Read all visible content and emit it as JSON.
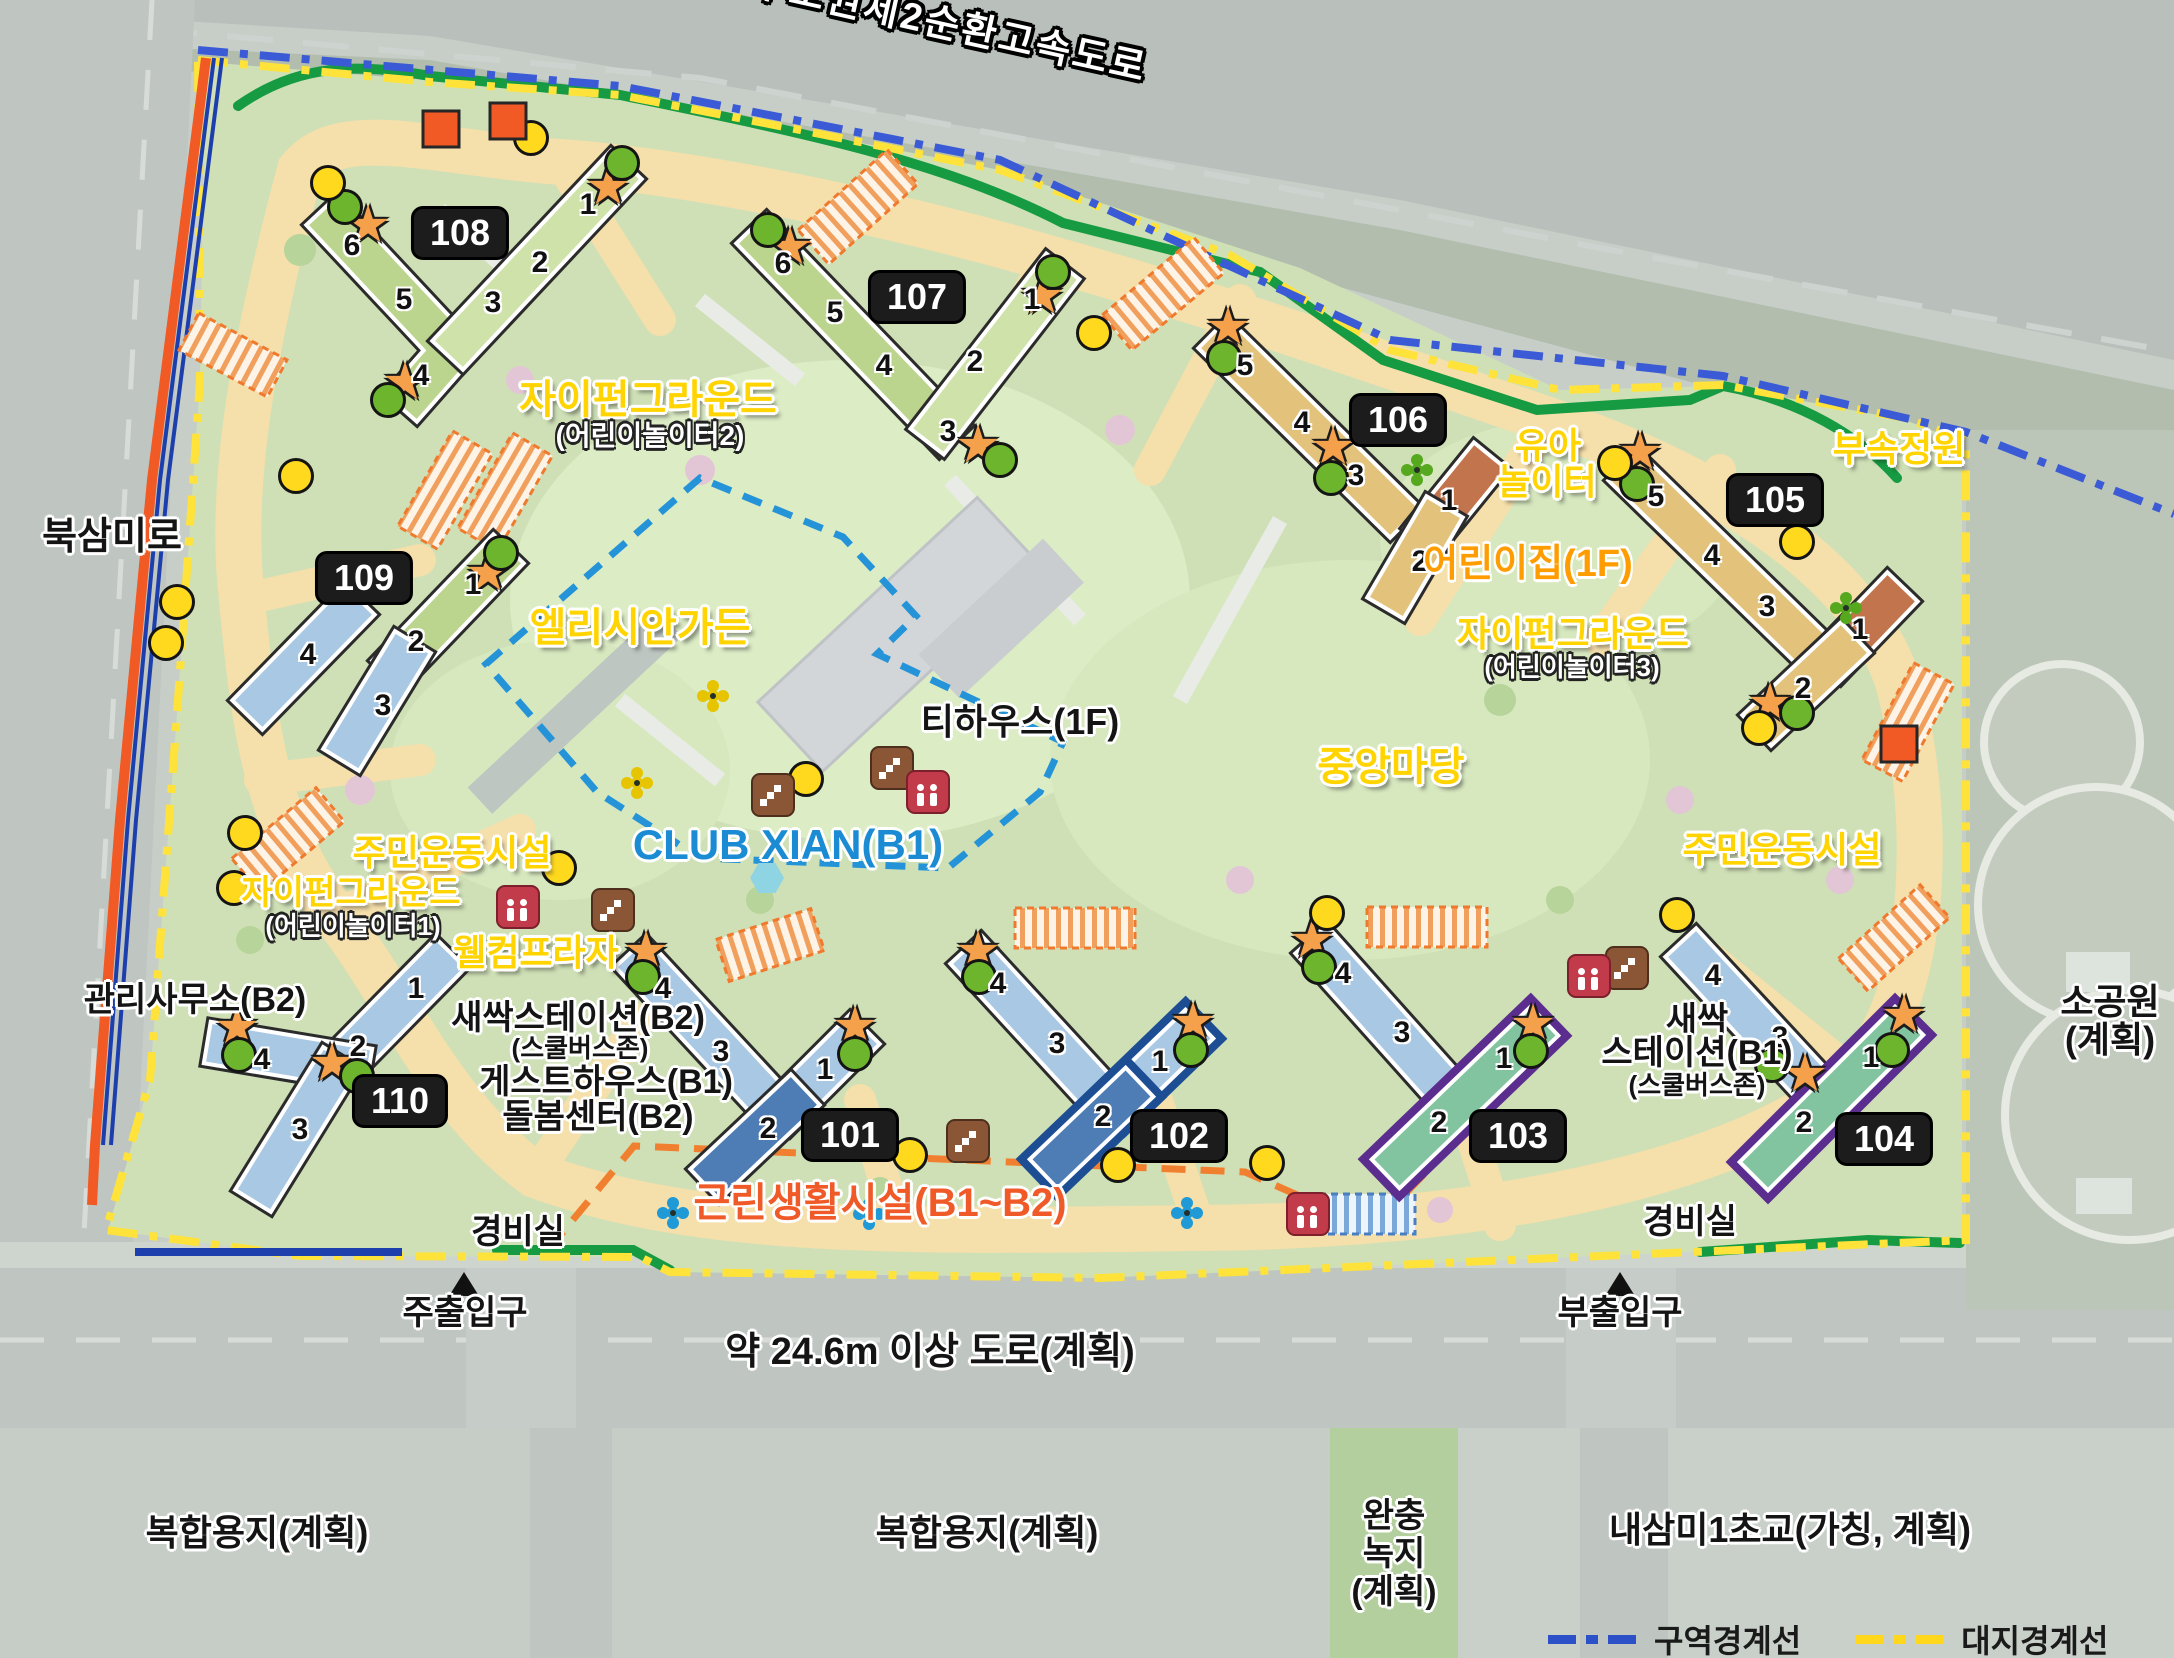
{
  "legend": {
    "zone_label": "구역경계선",
    "site_label": "대지경계선"
  },
  "labels": [
    {
      "text": "수도권제2순환고속도로",
      "x": 950,
      "y": 26,
      "size": 38,
      "style": "highway",
      "rotate": 12.5
    },
    {
      "text": "북삼미로",
      "x": 112,
      "y": 537,
      "size": 38,
      "style": "black"
    },
    {
      "text": "자이펀그라운드",
      "x": 648,
      "y": 400,
      "size": 40,
      "style": "yellow"
    },
    {
      "text": "(어린이놀이터2)",
      "x": 650,
      "y": 436,
      "size": 28,
      "style": "white"
    },
    {
      "text": "엘리시안가든",
      "x": 640,
      "y": 628,
      "size": 40,
      "style": "yellow"
    },
    {
      "text": "CLUB XIAN(B1)",
      "x": 788,
      "y": 845,
      "size": 42,
      "style": "blue"
    },
    {
      "text": "티하우스(1F)",
      "x": 1020,
      "y": 722,
      "size": 36,
      "style": "black"
    },
    {
      "text": "유아",
      "x": 1548,
      "y": 446,
      "size": 36,
      "style": "yellow"
    },
    {
      "text": "놀이터",
      "x": 1547,
      "y": 482,
      "size": 36,
      "style": "yellow"
    },
    {
      "text": "어린이집(1F)",
      "x": 1528,
      "y": 564,
      "size": 38,
      "style": "orange"
    },
    {
      "text": "자이펀그라운드",
      "x": 1573,
      "y": 634,
      "size": 36,
      "style": "yellow"
    },
    {
      "text": "(어린이놀이터3)",
      "x": 1572,
      "y": 667,
      "size": 26,
      "style": "white"
    },
    {
      "text": "부속정원",
      "x": 1899,
      "y": 449,
      "size": 36,
      "style": "yellow"
    },
    {
      "text": "중앙마당",
      "x": 1391,
      "y": 767,
      "size": 40,
      "style": "yellow"
    },
    {
      "text": "주민운동시설",
      "x": 452,
      "y": 853,
      "size": 36,
      "style": "yellow"
    },
    {
      "text": "자이펀그라운드",
      "x": 351,
      "y": 893,
      "size": 34,
      "style": "yellow"
    },
    {
      "text": "(어린이놀이터1)",
      "x": 353,
      "y": 926,
      "size": 26,
      "style": "white"
    },
    {
      "text": "웰컴프라자",
      "x": 536,
      "y": 953,
      "size": 36,
      "style": "yellow"
    },
    {
      "text": "주민운동시설",
      "x": 1782,
      "y": 850,
      "size": 36,
      "style": "yellow"
    },
    {
      "text": "관리사무소(B2)",
      "x": 195,
      "y": 1000,
      "size": 34,
      "style": "black"
    },
    {
      "text": "새싹스테이션(B2)",
      "x": 578,
      "y": 1018,
      "size": 34,
      "style": "black"
    },
    {
      "text": "(스쿨버스존)",
      "x": 580,
      "y": 1048,
      "size": 26,
      "style": "black"
    },
    {
      "text": "게스트하우스(B1)",
      "x": 606,
      "y": 1082,
      "size": 34,
      "style": "black"
    },
    {
      "text": "돌봄센터(B2)",
      "x": 598,
      "y": 1117,
      "size": 34,
      "style": "black"
    },
    {
      "text": "새싹",
      "x": 1697,
      "y": 1020,
      "size": 34,
      "style": "black"
    },
    {
      "text": "스테이션(B1)",
      "x": 1697,
      "y": 1053,
      "size": 34,
      "style": "black"
    },
    {
      "text": "(스쿨버스존)",
      "x": 1697,
      "y": 1085,
      "size": 26,
      "style": "black"
    },
    {
      "text": "근린생활시설(B1~B2)",
      "x": 880,
      "y": 1203,
      "size": 40,
      "style": "orangeb"
    },
    {
      "text": "경비실",
      "x": 518,
      "y": 1232,
      "size": 34,
      "style": "black"
    },
    {
      "text": "경비실",
      "x": 1690,
      "y": 1222,
      "size": 34,
      "style": "black"
    },
    {
      "text": "주출입구",
      "x": 465,
      "y": 1313,
      "size": 34,
      "style": "black"
    },
    {
      "text": "부출입구",
      "x": 1620,
      "y": 1313,
      "size": 34,
      "style": "black"
    },
    {
      "text": "약 24.6m 이상 도로(계획)",
      "x": 930,
      "y": 1352,
      "size": 38,
      "style": "black"
    },
    {
      "text": "복합용지(계획)",
      "x": 257,
      "y": 1533,
      "size": 36,
      "style": "black"
    },
    {
      "text": "복합용지(계획)",
      "x": 987,
      "y": 1533,
      "size": 36,
      "style": "black"
    },
    {
      "text": "완충",
      "x": 1394,
      "y": 1516,
      "size": 34,
      "style": "black"
    },
    {
      "text": "녹지",
      "x": 1394,
      "y": 1554,
      "size": 34,
      "style": "black"
    },
    {
      "text": "(계획)",
      "x": 1394,
      "y": 1592,
      "size": 34,
      "style": "black"
    },
    {
      "text": "내삼미1초교(가칭, 계획)",
      "x": 1790,
      "y": 1530,
      "size": 36,
      "style": "black"
    },
    {
      "text": "소공원",
      "x": 2110,
      "y": 1002,
      "size": 36,
      "style": "black"
    },
    {
      "text": "(계획)",
      "x": 2110,
      "y": 1040,
      "size": 36,
      "style": "black"
    }
  ],
  "entrance_triangles": [
    {
      "x": 464,
      "y": 1284
    },
    {
      "x": 1620,
      "y": 1284
    }
  ],
  "buildings": [
    {
      "id": "108",
      "badge_x": 460,
      "badge_y": 233,
      "segments": [
        {
          "d": "M336,226 L452,350 L415,392",
          "c": "#bcd58e"
        },
        {
          "d": "M612,180 L462,340",
          "c": "#cfe2aa"
        }
      ],
      "units": [
        {
          "n": "6",
          "x": 352,
          "y": 246
        },
        {
          "n": "5",
          "x": 404,
          "y": 300
        },
        {
          "n": "4",
          "x": 421,
          "y": 376
        },
        {
          "n": "1",
          "x": 588,
          "y": 205
        },
        {
          "n": "2",
          "x": 540,
          "y": 263
        },
        {
          "n": "3",
          "x": 493,
          "y": 303
        }
      ]
    },
    {
      "id": "107",
      "badge_x": 917,
      "badge_y": 297,
      "segments": [
        {
          "d": "M766,244 L940,425",
          "c": "#bcd58e"
        },
        {
          "d": "M1050,283 L940,425",
          "c": "#cfe2aa"
        }
      ],
      "units": [
        {
          "n": "6",
          "x": 783,
          "y": 264
        },
        {
          "n": "5",
          "x": 835,
          "y": 313
        },
        {
          "n": "4",
          "x": 884,
          "y": 366
        },
        {
          "n": "3",
          "x": 948,
          "y": 432
        },
        {
          "n": "2",
          "x": 975,
          "y": 362
        },
        {
          "n": "1",
          "x": 1032,
          "y": 300
        }
      ]
    },
    {
      "id": "106",
      "badge_x": 1398,
      "badge_y": 420,
      "segments": [
        {
          "d": "M1228,348 L1390,508",
          "c": "#e3c27c"
        },
        {
          "d": "M1477,472 L1434,525",
          "c": "#c2754d"
        },
        {
          "d": "M1434,525 L1396,590",
          "c": "#e3c27c"
        }
      ],
      "units": [
        {
          "n": "5",
          "x": 1245,
          "y": 366
        },
        {
          "n": "4",
          "x": 1302,
          "y": 423
        },
        {
          "n": "3",
          "x": 1356,
          "y": 476
        },
        {
          "n": "1",
          "x": 1449,
          "y": 501
        },
        {
          "n": "2",
          "x": 1420,
          "y": 562
        }
      ]
    },
    {
      "id": "105",
      "badge_x": 1775,
      "badge_y": 500,
      "segments": [
        {
          "d": "M1638,480 L1800,638",
          "c": "#e3c27c"
        },
        {
          "d": "M1888,602 L1840,652",
          "c": "#c2754d"
        },
        {
          "d": "M1840,652 L1772,716",
          "c": "#e3c27c"
        }
      ],
      "units": [
        {
          "n": "5",
          "x": 1656,
          "y": 497
        },
        {
          "n": "4",
          "x": 1712,
          "y": 556
        },
        {
          "n": "3",
          "x": 1767,
          "y": 607
        },
        {
          "n": "1",
          "x": 1860,
          "y": 630
        },
        {
          "n": "2",
          "x": 1803,
          "y": 689
        }
      ]
    },
    {
      "id": "109",
      "badge_x": 364,
      "badge_y": 578,
      "segments": [
        {
          "d": "M494,564 L402,660",
          "c": "#bcd58e"
        },
        {
          "d": "M402,660 L352,742",
          "c": "#a9c8e4"
        },
        {
          "d": "M345,615 L262,700",
          "c": "#a9c8e4"
        }
      ],
      "units": [
        {
          "n": "1",
          "x": 473,
          "y": 585
        },
        {
          "n": "2",
          "x": 416,
          "y": 642
        },
        {
          "n": "3",
          "x": 383,
          "y": 706
        },
        {
          "n": "4",
          "x": 308,
          "y": 655
        }
      ]
    },
    {
      "id": "110",
      "badge_x": 400,
      "badge_y": 1101,
      "segments": [
        {
          "d": "M436,968 L330,1076",
          "c": "#a9c8e4"
        },
        {
          "d": "M348,1066 L228,1046",
          "c": "#a9c8e4"
        },
        {
          "d": "M330,1076 L264,1183",
          "c": "#a9c8e4"
        }
      ],
      "units": [
        {
          "n": "1",
          "x": 416,
          "y": 989
        },
        {
          "n": "2",
          "x": 358,
          "y": 1047
        },
        {
          "n": "4",
          "x": 262,
          "y": 1060
        },
        {
          "n": "3",
          "x": 300,
          "y": 1130
        }
      ]
    },
    {
      "id": "101",
      "badge_x": 850,
      "badge_y": 1135,
      "segments": [
        {
          "d": "M645,968 L762,1094",
          "c": "#a9c8e4"
        },
        {
          "d": "M850,1044 L790,1104",
          "c": "#a9c8e4"
        },
        {
          "d": "M790,1104 L720,1170",
          "c": "#4e7cb4"
        }
      ],
      "units": [
        {
          "n": "4",
          "x": 663,
          "y": 989
        },
        {
          "n": "3",
          "x": 721,
          "y": 1052
        },
        {
          "n": "1",
          "x": 825,
          "y": 1070
        },
        {
          "n": "2",
          "x": 768,
          "y": 1129
        }
      ]
    },
    {
      "id": "102",
      "badge_x": 1179,
      "badge_y": 1136,
      "segments": [
        {
          "d": "M980,965 L1095,1090",
          "c": "#a9c8e4"
        },
        {
          "d": "M1185,1038 L1125,1096",
          "c": "#a9c8e4",
          "o": "#1d4e94"
        },
        {
          "d": "M1125,1096 L1058,1160",
          "c": "#4e7cb4",
          "o": "#1d4e94"
        }
      ],
      "units": [
        {
          "n": "4",
          "x": 998,
          "y": 984
        },
        {
          "n": "3",
          "x": 1057,
          "y": 1044
        },
        {
          "n": "1",
          "x": 1160,
          "y": 1062
        },
        {
          "n": "2",
          "x": 1103,
          "y": 1117
        }
      ]
    },
    {
      "id": "103",
      "badge_x": 1518,
      "badge_y": 1136,
      "segments": [
        {
          "d": "M1325,955 L1435,1078",
          "c": "#a9c8e4"
        },
        {
          "d": "M1530,1035 L1400,1160",
          "c": "#82c4a0",
          "o": "#5b2d8e"
        }
      ],
      "units": [
        {
          "n": "4",
          "x": 1343,
          "y": 974
        },
        {
          "n": "3",
          "x": 1402,
          "y": 1033
        },
        {
          "n": "1",
          "x": 1504,
          "y": 1059
        },
        {
          "n": "2",
          "x": 1439,
          "y": 1123
        }
      ]
    },
    {
      "id": "104",
      "badge_x": 1884,
      "badge_y": 1139,
      "segments": [
        {
          "d": "M1695,958 L1808,1080",
          "c": "#a9c8e4"
        },
        {
          "d": "M1895,1035 L1768,1162",
          "c": "#82c4a0",
          "o": "#5b2d8e"
        }
      ],
      "units": [
        {
          "n": "4",
          "x": 1713,
          "y": 976
        },
        {
          "n": "3",
          "x": 1780,
          "y": 1038
        },
        {
          "n": "1",
          "x": 1871,
          "y": 1058
        },
        {
          "n": "2",
          "x": 1804,
          "y": 1123
        }
      ]
    }
  ],
  "markers": {
    "stars": [
      [
        368,
        225
      ],
      [
        405,
        382
      ],
      [
        608,
        187
      ],
      [
        790,
        247
      ],
      [
        1042,
        296
      ],
      [
        978,
        445
      ],
      [
        1228,
        327
      ],
      [
        1333,
        447
      ],
      [
        1640,
        452
      ],
      [
        1770,
        703
      ],
      [
        488,
        573
      ],
      [
        237,
        1027
      ],
      [
        332,
        1063
      ],
      [
        646,
        951
      ],
      [
        855,
        1026
      ],
      [
        978,
        951
      ],
      [
        1193,
        1022
      ],
      [
        1312,
        940
      ],
      [
        1533,
        1024
      ],
      [
        1805,
        1074
      ],
      [
        1904,
        1015
      ]
    ],
    "green_dots": [
      [
        345,
        207
      ],
      [
        388,
        400
      ],
      [
        622,
        163
      ],
      [
        768,
        230
      ],
      [
        1053,
        272
      ],
      [
        1000,
        460
      ],
      [
        1224,
        358
      ],
      [
        1331,
        478
      ],
      [
        1637,
        484
      ],
      [
        1797,
        713
      ],
      [
        501,
        553
      ],
      [
        239,
        1055
      ],
      [
        357,
        1076
      ],
      [
        643,
        977
      ],
      [
        855,
        1054
      ],
      [
        979,
        977
      ],
      [
        1191,
        1050
      ],
      [
        1319,
        967
      ],
      [
        1531,
        1051
      ],
      [
        1772,
        1065
      ],
      [
        1892,
        1050
      ]
    ],
    "yellow_dots": [
      [
        328,
        183
      ],
      [
        531,
        138
      ],
      [
        1094,
        333
      ],
      [
        1615,
        463
      ],
      [
        1797,
        542
      ],
      [
        1759,
        728
      ],
      [
        296,
        476
      ],
      [
        177,
        602
      ],
      [
        166,
        643
      ],
      [
        245,
        833
      ],
      [
        234,
        888
      ],
      [
        559,
        868
      ],
      [
        806,
        779
      ],
      [
        910,
        1155
      ],
      [
        1118,
        1165
      ],
      [
        1267,
        1163
      ],
      [
        1327,
        913
      ],
      [
        1677,
        915
      ]
    ],
    "orange_squares": [
      [
        441,
        129
      ],
      [
        508,
        121
      ],
      [
        1899,
        744
      ]
    ],
    "hexagons": [
      [
        767,
        878
      ]
    ]
  },
  "icons": {
    "stairs": [
      [
        773,
        795
      ],
      [
        892,
        768
      ],
      [
        613,
        910
      ],
      [
        968,
        1141
      ],
      [
        1627,
        968
      ]
    ],
    "elevators": [
      [
        518,
        907
      ],
      [
        928,
        792
      ],
      [
        1589,
        976
      ],
      [
        1308,
        1214
      ]
    ],
    "pinwheels": [
      {
        "x": 713,
        "y": 696,
        "c": "#e6c400"
      },
      {
        "x": 637,
        "y": 783,
        "c": "#e6c400"
      },
      {
        "x": 1417,
        "y": 470,
        "c": "#56a81e"
      },
      {
        "x": 1846,
        "y": 608,
        "c": "#56a81e"
      },
      {
        "x": 673,
        "y": 1213,
        "c": "#1f9ad6"
      },
      {
        "x": 869,
        "y": 1214,
        "c": "#1f9ad6"
      },
      {
        "x": 1187,
        "y": 1213,
        "c": "#1f9ad6"
      }
    ]
  },
  "parking": [
    {
      "x": 858,
      "y": 207,
      "w": 120,
      "h": 46,
      "r": -42,
      "t": "orange"
    },
    {
      "x": 1163,
      "y": 294,
      "w": 120,
      "h": 46,
      "r": -40,
      "t": "orange"
    },
    {
      "x": 233,
      "y": 355,
      "w": 100,
      "h": 42,
      "r": 28,
      "t": "orange"
    },
    {
      "x": 445,
      "y": 490,
      "w": 46,
      "h": 110,
      "r": 30,
      "t": "orange"
    },
    {
      "x": 505,
      "y": 492,
      "w": 46,
      "h": 110,
      "r": 30,
      "t": "orange"
    },
    {
      "x": 288,
      "y": 840,
      "w": 110,
      "h": 44,
      "r": -40,
      "t": "orange"
    },
    {
      "x": 770,
      "y": 945,
      "w": 100,
      "h": 44,
      "r": -18,
      "t": "orange"
    },
    {
      "x": 1075,
      "y": 928,
      "w": 120,
      "h": 40,
      "r": 0,
      "t": "orange"
    },
    {
      "x": 1427,
      "y": 927,
      "w": 120,
      "h": 40,
      "r": 0,
      "t": "orange"
    },
    {
      "x": 1894,
      "y": 938,
      "w": 110,
      "h": 44,
      "r": -42,
      "t": "orange"
    },
    {
      "x": 1908,
      "y": 722,
      "w": 46,
      "h": 110,
      "r": 28,
      "t": "orange"
    },
    {
      "x": 1355,
      "y": 1214,
      "w": 120,
      "h": 40,
      "r": 0,
      "t": "blue"
    }
  ]
}
